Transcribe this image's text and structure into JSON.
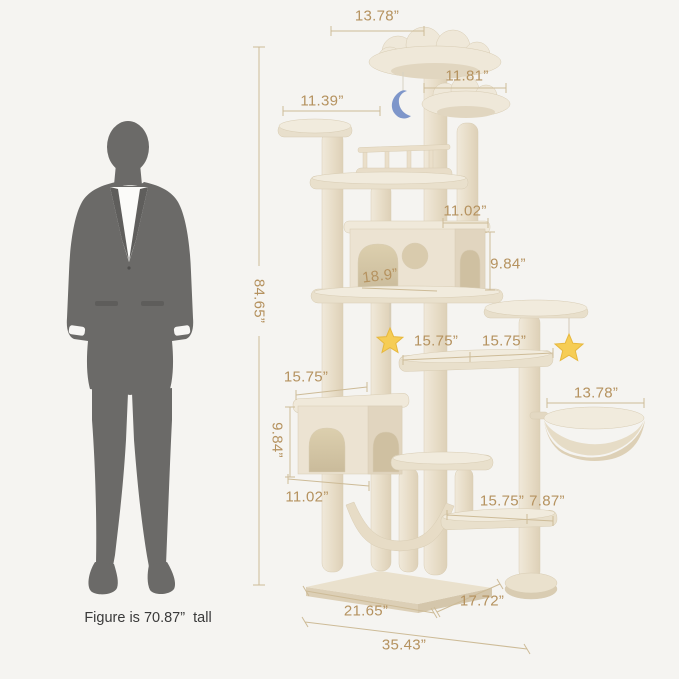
{
  "figure": {
    "caption": "Figure is 70.87”  tall"
  },
  "labels": {
    "top_perch_width": "13.78”",
    "upper_right_perch_width": "11.81”",
    "upper_left_platform_width": "11.39”",
    "overall_height": "84.65”",
    "upper_condo_depth": "11.02”",
    "upper_condo_height": "9.84”",
    "upper_condo_interior_width": "18.9”",
    "middle_left_platform_width": "15.75”",
    "middle_right_platform_width": "15.75”",
    "basket_diameter": "13.78”",
    "lower_condo_top_width": "15.75”",
    "lower_condo_height": "9.84”",
    "lower_condo_front_width": "11.02”",
    "bottom_platform_width": "15.75”",
    "bottom_platform_depth": "7.87”",
    "base_front_width": "21.65”",
    "base_side_depth": "17.72”",
    "overall_width": "35.43”"
  },
  "icons": {
    "moon_toy": "crescent-moon",
    "star_toy_left": "star",
    "star_toy_right": "star"
  },
  "colors": {
    "background": "#f5f4f1",
    "dimension_text": "#b5925f",
    "dimension_line": "#cdbb97",
    "tree_plush": "#ece4d3",
    "silhouette": "#6b6a68",
    "moon_toy": "#7e96ca",
    "star_toy": "#f6cd55"
  }
}
